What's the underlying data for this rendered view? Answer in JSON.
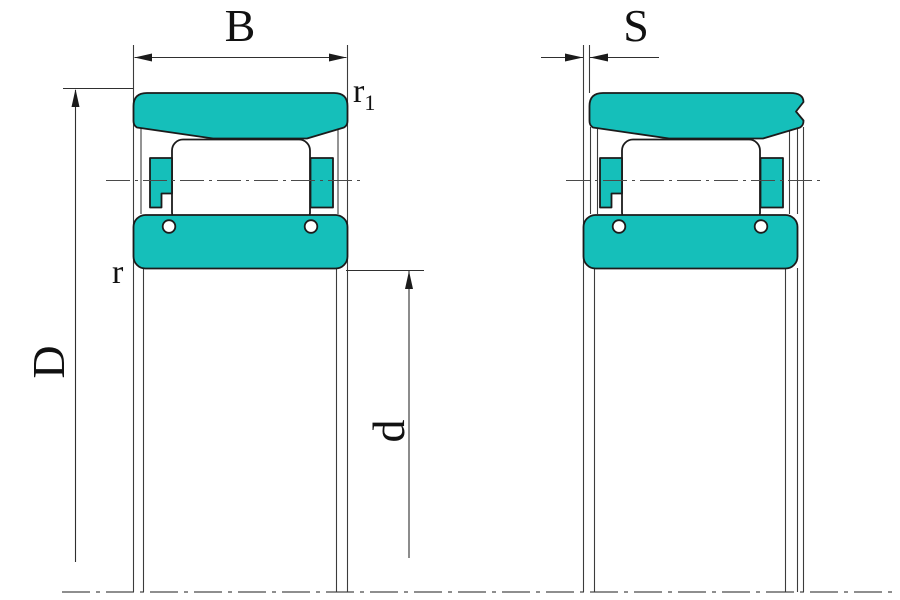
{
  "figure": {
    "labels": {
      "width": "B",
      "ring_offset": "S",
      "outer_chamfer": {
        "base": "r",
        "sub": "1"
      },
      "inner_chamfer": "r",
      "outside_diameter": "D",
      "bore_diameter": "d"
    },
    "colors": {
      "ring_fill": "#15bfba",
      "outline": "#1b1b1b",
      "thin_line": "#3c3c3c",
      "background": "#ffffff"
    }
  }
}
